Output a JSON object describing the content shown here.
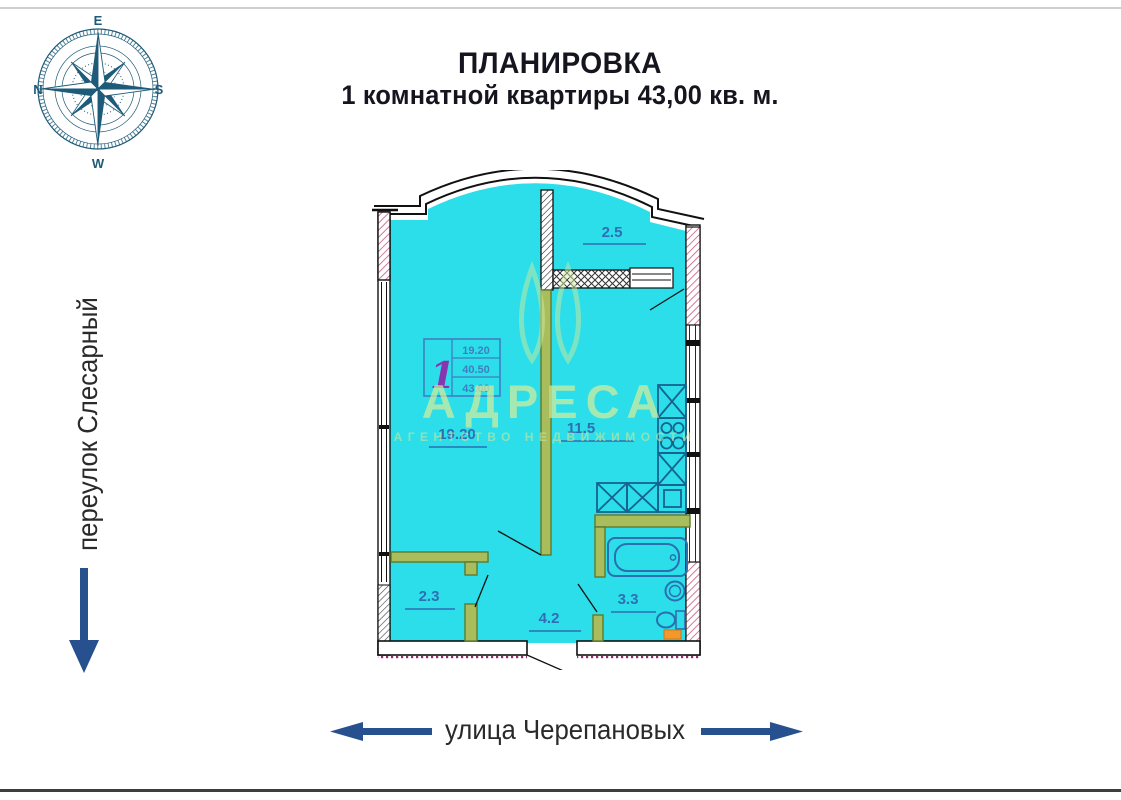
{
  "page": {
    "title_line1": "ПЛАНИРОВКА",
    "title_line2": "1 комнатной квартиры 43,00 кв. м."
  },
  "compass": {
    "top": "E",
    "right": "S",
    "bottom": "W",
    "left": "N"
  },
  "streets": {
    "left": "переулок Слесарный",
    "bottom": "улица Черепановых"
  },
  "plan": {
    "labels": {
      "balcony": "2.5",
      "living_room": "19.20",
      "kitchen": "11.5",
      "wardrobe": "2.3",
      "hallway": "4.2",
      "bathroom": "3.3"
    },
    "stamp": {
      "rooms": "1",
      "row1": "19.20",
      "row2": "40.50",
      "row3": "43.00"
    }
  },
  "watermark": {
    "name": "АДРЕСА",
    "subtitle": "АГЕНТСТВО НЕДВИЖИМОСТИ"
  },
  "colors": {
    "floor_fill": "#2bdee9",
    "wall": "#111111",
    "partition": "#a9bd5c",
    "fixtures": "#17628f",
    "labels": "#2e6fb4",
    "arrows": "#27508f",
    "compass": "#1d5b78",
    "watermark": "#d6ec9c",
    "hatch_pink": "#c4597f",
    "appliance_orange": "#f2992e"
  }
}
